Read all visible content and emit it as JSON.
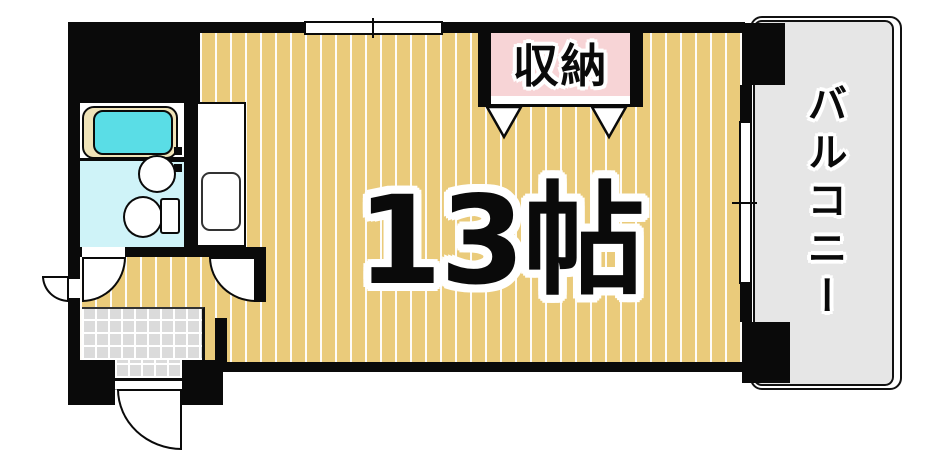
{
  "floorplan": {
    "rooms": {
      "main": {
        "label": "13帖"
      },
      "closet": {
        "label": "収納"
      },
      "balcony": {
        "label": "バルコニー"
      }
    },
    "colors": {
      "flooring": "#EACB7B",
      "closet_fill": "#F7D4D6",
      "balcony_fill": "#E6E6E6",
      "entrance_tile": "#DBDBDB",
      "washroom_floor": "#CFF3F8",
      "bathtub_water": "#5ADDE6",
      "bathtub_rim": "#EFE3B8",
      "wall": "#0A0A0A"
    }
  }
}
